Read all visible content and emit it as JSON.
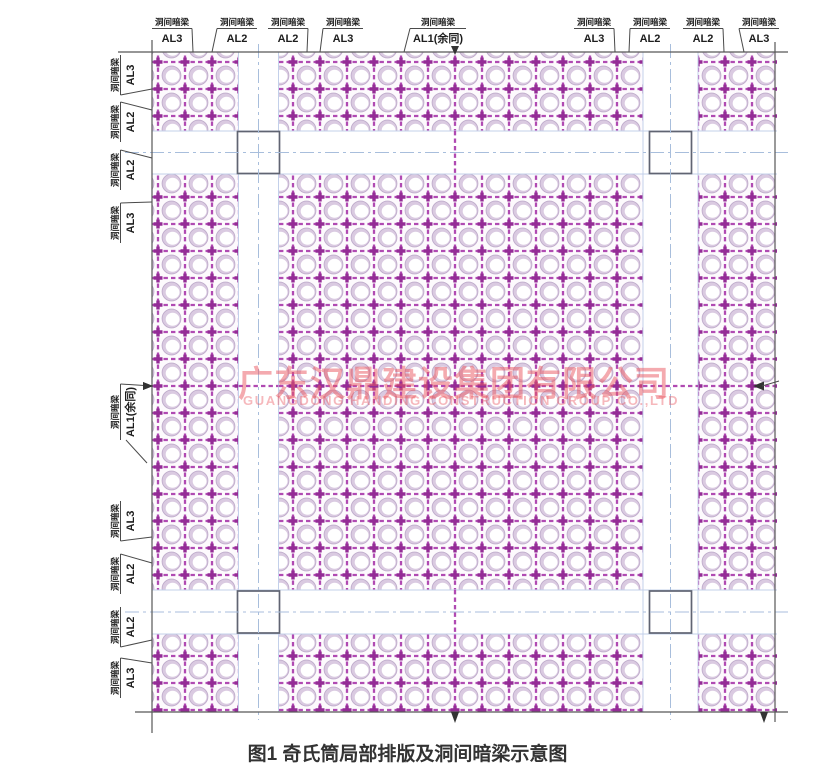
{
  "figure_caption": "图1 奇氏筒局部排版及洞间暗梁示意图",
  "watermark": {
    "cn": "广东汉鼎建设集团有限公司",
    "en": "GUANGDONG HANDING CONSTRUCTION GROUP CO.,LTD"
  },
  "beam_tag": "洞间暗梁",
  "top_beam_labels": [
    {
      "code": "AL3",
      "x": 172,
      "target_x": 193,
      "slash": "right"
    },
    {
      "code": "AL2",
      "x": 237,
      "target_x": 212,
      "slash": "left"
    },
    {
      "code": "AL2",
      "x": 288,
      "target_x": 307,
      "slash": "right"
    },
    {
      "code": "AL3",
      "x": 343,
      "target_x": 320,
      "slash": "left"
    },
    {
      "code": "AL1(余同)",
      "x": 438,
      "target_x": 404,
      "slash": "left",
      "arrow_x": 455
    },
    {
      "code": "AL3",
      "x": 594,
      "target_x": 615,
      "slash": "right"
    },
    {
      "code": "AL2",
      "x": 650,
      "target_x": 629,
      "slash": "left"
    },
    {
      "code": "AL2",
      "x": 703,
      "target_x": 724,
      "slash": "right"
    },
    {
      "code": "AL3",
      "x": 759,
      "target_x": 744,
      "slash": "left"
    }
  ],
  "left_beam_labels": [
    {
      "code": "AL3",
      "y": 75,
      "target_y": 89
    },
    {
      "code": "AL2",
      "y": 122,
      "target_y": 110
    },
    {
      "code": "AL2",
      "y": 170,
      "target_y": 158
    },
    {
      "code": "AL3",
      "y": 223,
      "target_y": 202
    },
    {
      "code": "AL1(余同)",
      "y": 412,
      "target_y": 386,
      "arrow_y": 386
    },
    {
      "code": "AL3",
      "y": 521,
      "target_y": 537
    },
    {
      "code": "AL2",
      "y": 574,
      "target_y": 563
    },
    {
      "code": "AL2",
      "y": 627,
      "target_y": 640
    },
    {
      "code": "AL3",
      "y": 678,
      "target_y": 663
    }
  ],
  "drawing": {
    "type": "structural-plan",
    "beam_codes": [
      "AL1",
      "AL2",
      "AL3"
    ],
    "grid": {
      "pitch": 27,
      "region": [
        152,
        52,
        777,
        712
      ]
    },
    "columns_count": 4,
    "colors": {
      "beam_dash": "#b04ab2",
      "beam_node": "#942c96",
      "tube_ring": "#dacae1",
      "tube_hole": "#ffffff",
      "axis_line": "#a8bedc",
      "band_edge": "#c3d0ea",
      "border": "#585858",
      "watermark": "#e9555f",
      "caption": "#333333"
    }
  }
}
